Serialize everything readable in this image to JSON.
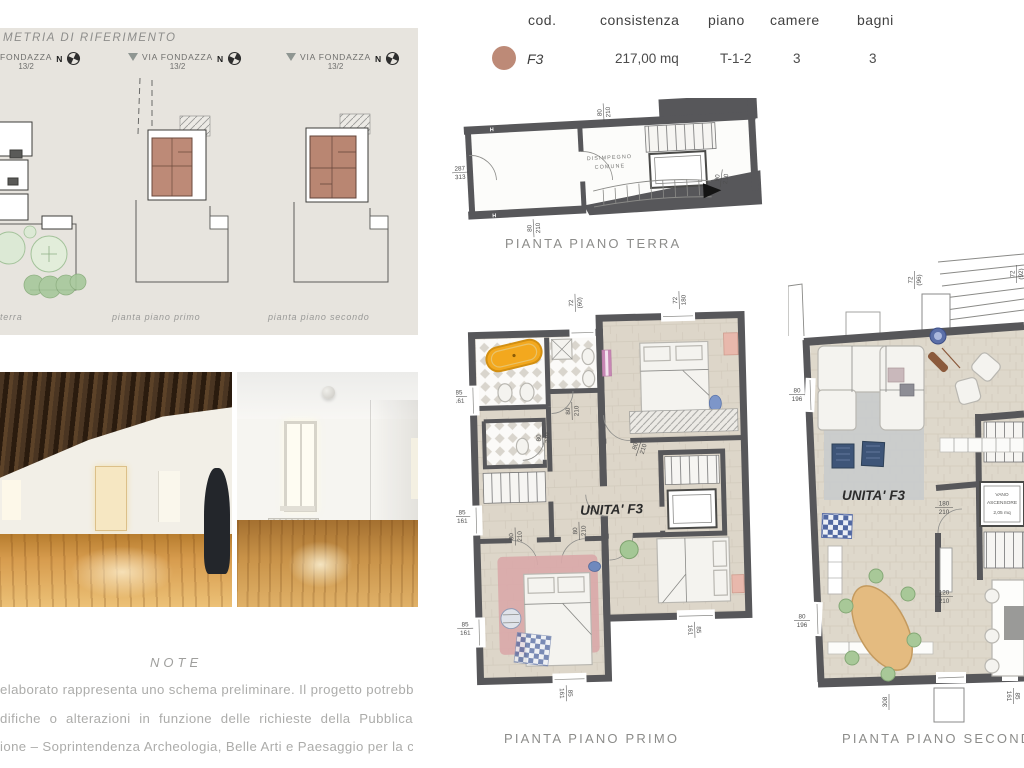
{
  "colors": {
    "accent_terracotta": "#bd8a77",
    "wall_grey": "#57575a",
    "panel_bg": "#e7e4de",
    "tub_orange": "#f3a81e",
    "rug_pink": "#d9a8a8",
    "pouf_blue": "#3e5578",
    "table_tan": "#e4bb80"
  },
  "reference_panel": {
    "title": "METRIA DI RIFERIMENTO",
    "north": "N",
    "sites": [
      {
        "street": "FONDAZZA",
        "civic": "13/2",
        "caption": "terra"
      },
      {
        "street": "VIA FONDAZZA",
        "civic": "13/2",
        "caption": "pianta piano primo"
      },
      {
        "street": "VIA FONDAZZA",
        "civic": "13/2",
        "caption": "pianta piano secondo"
      }
    ]
  },
  "unit_table": {
    "headers": {
      "cod": "cod.",
      "consistenza": "consistenza",
      "piano": "piano",
      "camere": "camere",
      "bagni": "bagni"
    },
    "row": {
      "cod": "F3",
      "consistenza": "217,00 mq",
      "piano": "T-1-2",
      "camere": "3",
      "bagni": "3"
    }
  },
  "plans": {
    "terra": {
      "caption": "PIANTA PIANO TERRA",
      "room": {
        "l1": "DISIMPEGNO",
        "l2": "COMUNE"
      },
      "h_marker": "H",
      "dims": {
        "left": {
          "a": "287",
          "b": "313"
        },
        "top": {
          "a": "80",
          "b": "210"
        },
        "bottom": {
          "a": "80",
          "b": "210"
        },
        "stair": {
          "a": "90",
          "b": "210"
        }
      }
    },
    "primo": {
      "caption": "PIANTA PIANO PRIMO",
      "unit": "UNITA' F3",
      "dims": {
        "top_left": {
          "a": "72",
          "b": "(60)"
        },
        "top_right": {
          "a": "72",
          "b": "180"
        },
        "win_left_1": {
          "a": "85",
          "b": "161"
        },
        "win_left_2": {
          "a": "85",
          "b": "161"
        },
        "win_left_3": {
          "a": "85",
          "b": "161"
        },
        "door_1": {
          "a": "80",
          "b": "210"
        },
        "door_2": {
          "a": "80",
          "b": "210"
        },
        "door_3": {
          "a": "80",
          "b": "210"
        },
        "door_4": {
          "a": "80",
          "b": "210"
        },
        "door_5": {
          "a": "80",
          "b": "210"
        },
        "win_bot_1": {
          "a": "85",
          "b": "161"
        },
        "win_bot_2": {
          "a": "85",
          "b": "161"
        }
      }
    },
    "secondo": {
      "caption": "PIANTA PIANO SECONDO",
      "unit": "UNITA' F3",
      "elevator": {
        "l1": "VANO",
        "l2": "ASCENSORE",
        "l3": "2,05 mq"
      },
      "dims": {
        "top_left": {
          "a": "72",
          "b": "(96)"
        },
        "top_right": {
          "a": "72",
          "b": "(92)"
        },
        "win_left_1": {
          "a": "80",
          "b": "196"
        },
        "win_left_2": {
          "a": "80",
          "b": "196"
        },
        "elev": {
          "a": "180",
          "b": "210"
        },
        "door": {
          "a": "120",
          "b": "210"
        },
        "win_bottom": "308",
        "win_right": {
          "a": "85",
          "b": "161"
        }
      }
    }
  },
  "note": {
    "heading": "NOTE",
    "lines": [
      "elaborato rappresenta uno schema preliminare. Il progetto potrebbe",
      "difiche o alterazioni in funzione delle richieste della Pubblica",
      "ione – Soprintendenza Archeologia, Belle Arti e Paesaggio per la città",
      "na di Bologna e del Comune di Bologna."
    ]
  }
}
